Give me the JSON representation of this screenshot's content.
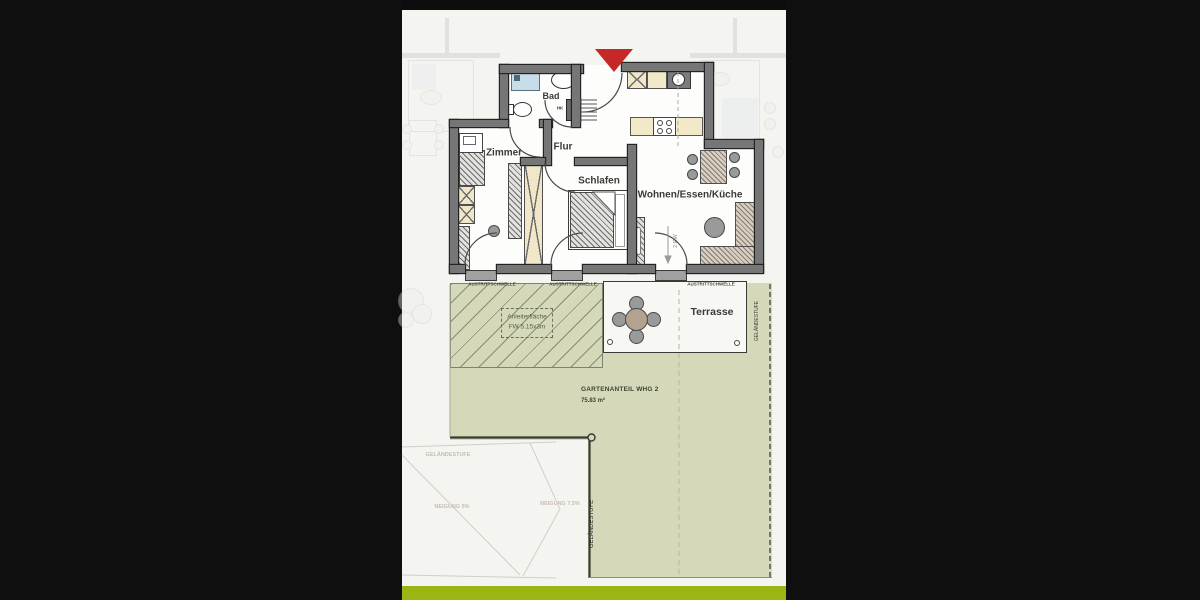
{
  "page": {
    "background": "#0f0f0f",
    "accent_bar_green": "#9cb513",
    "garden_green": "#d5d9ba",
    "entrance_marker_red": "#c62828"
  },
  "floorplan": {
    "rooms": [
      {
        "id": "bad",
        "label": "Bad"
      },
      {
        "id": "flur",
        "label": "Flur"
      },
      {
        "id": "zimmer",
        "label": "Zimmer"
      },
      {
        "id": "schlafen",
        "label": "Schlafen"
      },
      {
        "id": "wohnen",
        "label": "Wohnen/Essen/Küche"
      },
      {
        "id": "terrasse",
        "label": "Terrasse"
      }
    ],
    "thresholds": [
      "AUSTRITTSCHWELLE",
      "AUSTRITTSCHWELLE",
      "AUSTRITTSCHWELLE"
    ],
    "ladder_area": {
      "line1": "Anleiterfläche",
      "line2": "FW 5.15x3m"
    },
    "garden": {
      "title": "GARTENANTEIL WHG 2",
      "area": "75.83 m²"
    },
    "terrain_step_left": "GELÄNDESTUFE",
    "terrain_step_right": "GELÄNDESTUFE",
    "escape_route": "2.RW",
    "radiator": "HK",
    "neighbor_labels": [
      "GELÄNDESTUFE",
      "NEIGUNG 5%",
      "NEIGUNG 7.5%"
    ]
  }
}
